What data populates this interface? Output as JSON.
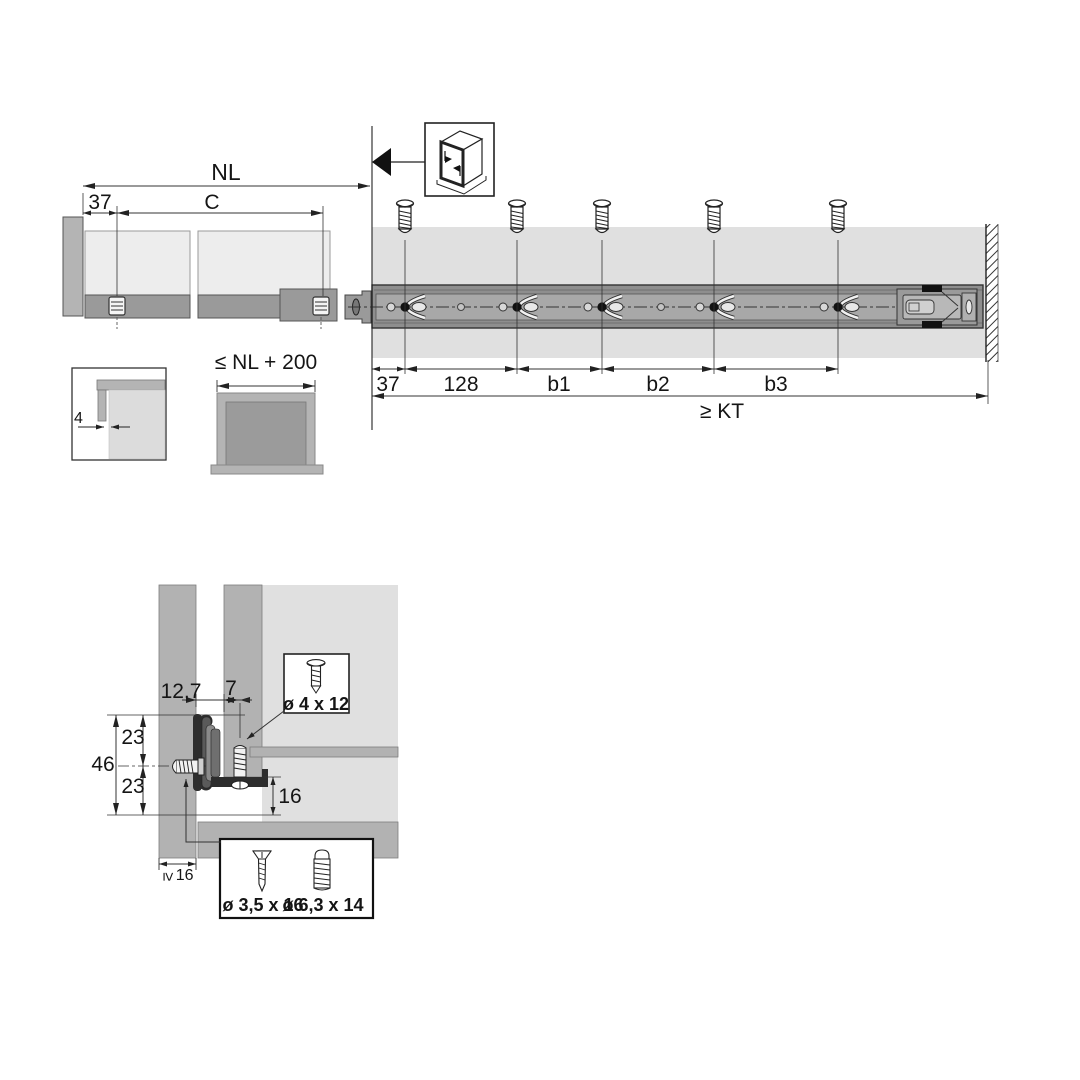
{
  "diagram": {
    "side_view": {
      "dim_nominal_length": "NL",
      "dim_front_offset": "37",
      "dim_adjust": "C"
    },
    "top_view": {
      "screw_spacing": [
        "37",
        "128",
        "b1",
        "b2",
        "b3"
      ],
      "dim_cabinet_depth": "≥ KT"
    },
    "front_gap_detail": {
      "dim_gap": "4"
    },
    "drawer_length_detail": {
      "dim_max_length": "≤ NL + 200"
    },
    "cross_section": {
      "dim_runner_offset": "12,7",
      "dim_screw_inset": "7",
      "dim_upper_hole": "23",
      "dim_total_height": "46",
      "dim_lower_hole": "23",
      "dim_bottom_clearance": "16",
      "dim_min_panel_symbol": "≥",
      "dim_min_panel_value": "16"
    },
    "screw_specs": {
      "drawer_bottom_screw": "ø 4 x 12",
      "countersunk_screw": "ø 3,5 x 16",
      "euro_screw": "ø 6,3 x 14"
    }
  }
}
